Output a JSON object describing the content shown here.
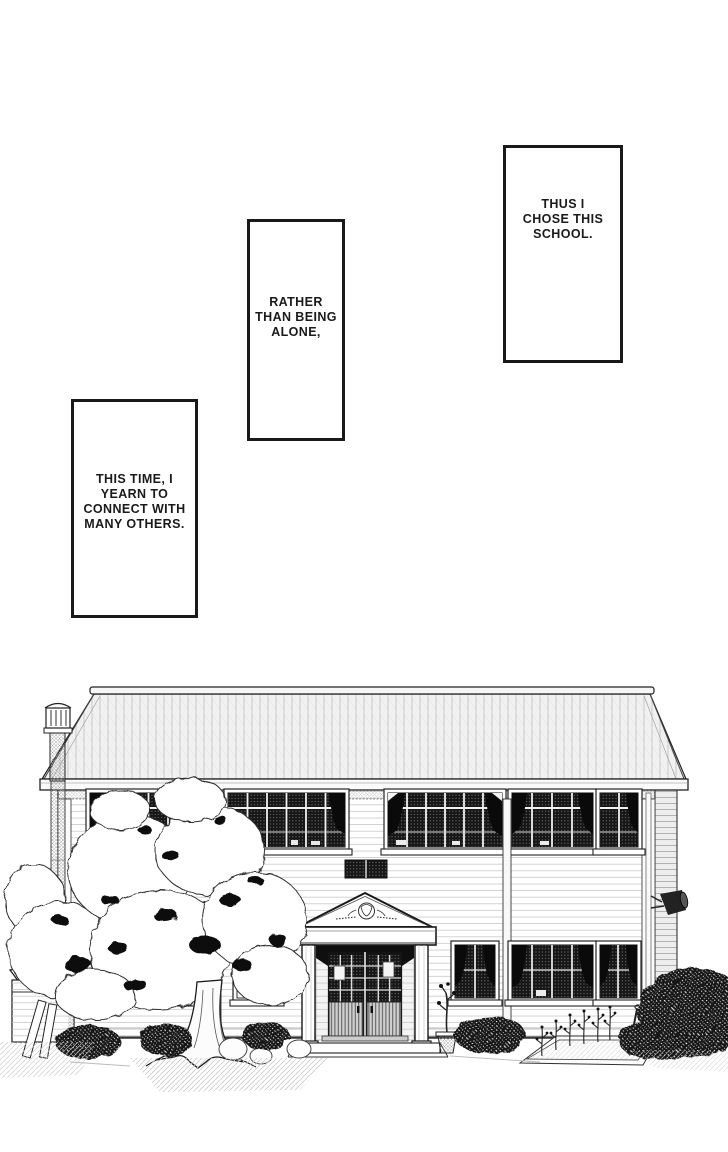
{
  "page": {
    "paper_color": "#ffffff",
    "ink_color": "#1a1a1a"
  },
  "panels": [
    {
      "text": "THUS I\nCHOSE THIS\nSCHOOL."
    },
    {
      "text": "RATHER\nTHAN BEING\nALONE,"
    },
    {
      "text": "THIS TIME, I\nYEARN TO\nCONNECT WITH\nMANY OTHERS."
    }
  ]
}
